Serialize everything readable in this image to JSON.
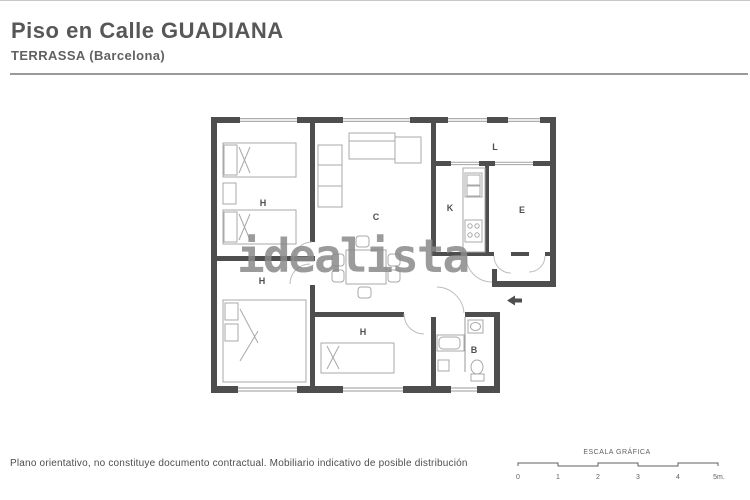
{
  "page": {
    "title": "Piso en Calle GUADIANA",
    "subtitle": "TERRASSA (Barcelona)"
  },
  "watermark": "idealista",
  "plan": {
    "rooms": [
      {
        "name": "bedroom-top-left",
        "label": "H"
      },
      {
        "name": "bedroom-bottom-left",
        "label": "H"
      },
      {
        "name": "bedroom-bottom-middle",
        "label": "H"
      },
      {
        "name": "living-room",
        "label": "C"
      },
      {
        "name": "kitchen",
        "label": "K"
      },
      {
        "name": "room-e",
        "label": "E"
      },
      {
        "name": "gallery",
        "label": "L"
      },
      {
        "name": "bathroom",
        "label": "B"
      }
    ]
  },
  "footer": {
    "disclaimer": "Plano orientativo, no constituye documento contractual. Mobiliario indicativo de posible distribución"
  },
  "scale": {
    "title": "ESCALA GRÁFICA",
    "ticks": [
      "0",
      "1",
      "2",
      "3",
      "4",
      "5m."
    ]
  },
  "colors": {
    "wall": "#4e4e4e",
    "furniture": "#a8a8a8",
    "window_line": "#9a9a9a",
    "door_arc": "#bdbdbd",
    "title_text": "#575757",
    "watermark": "#8a8a8a"
  }
}
